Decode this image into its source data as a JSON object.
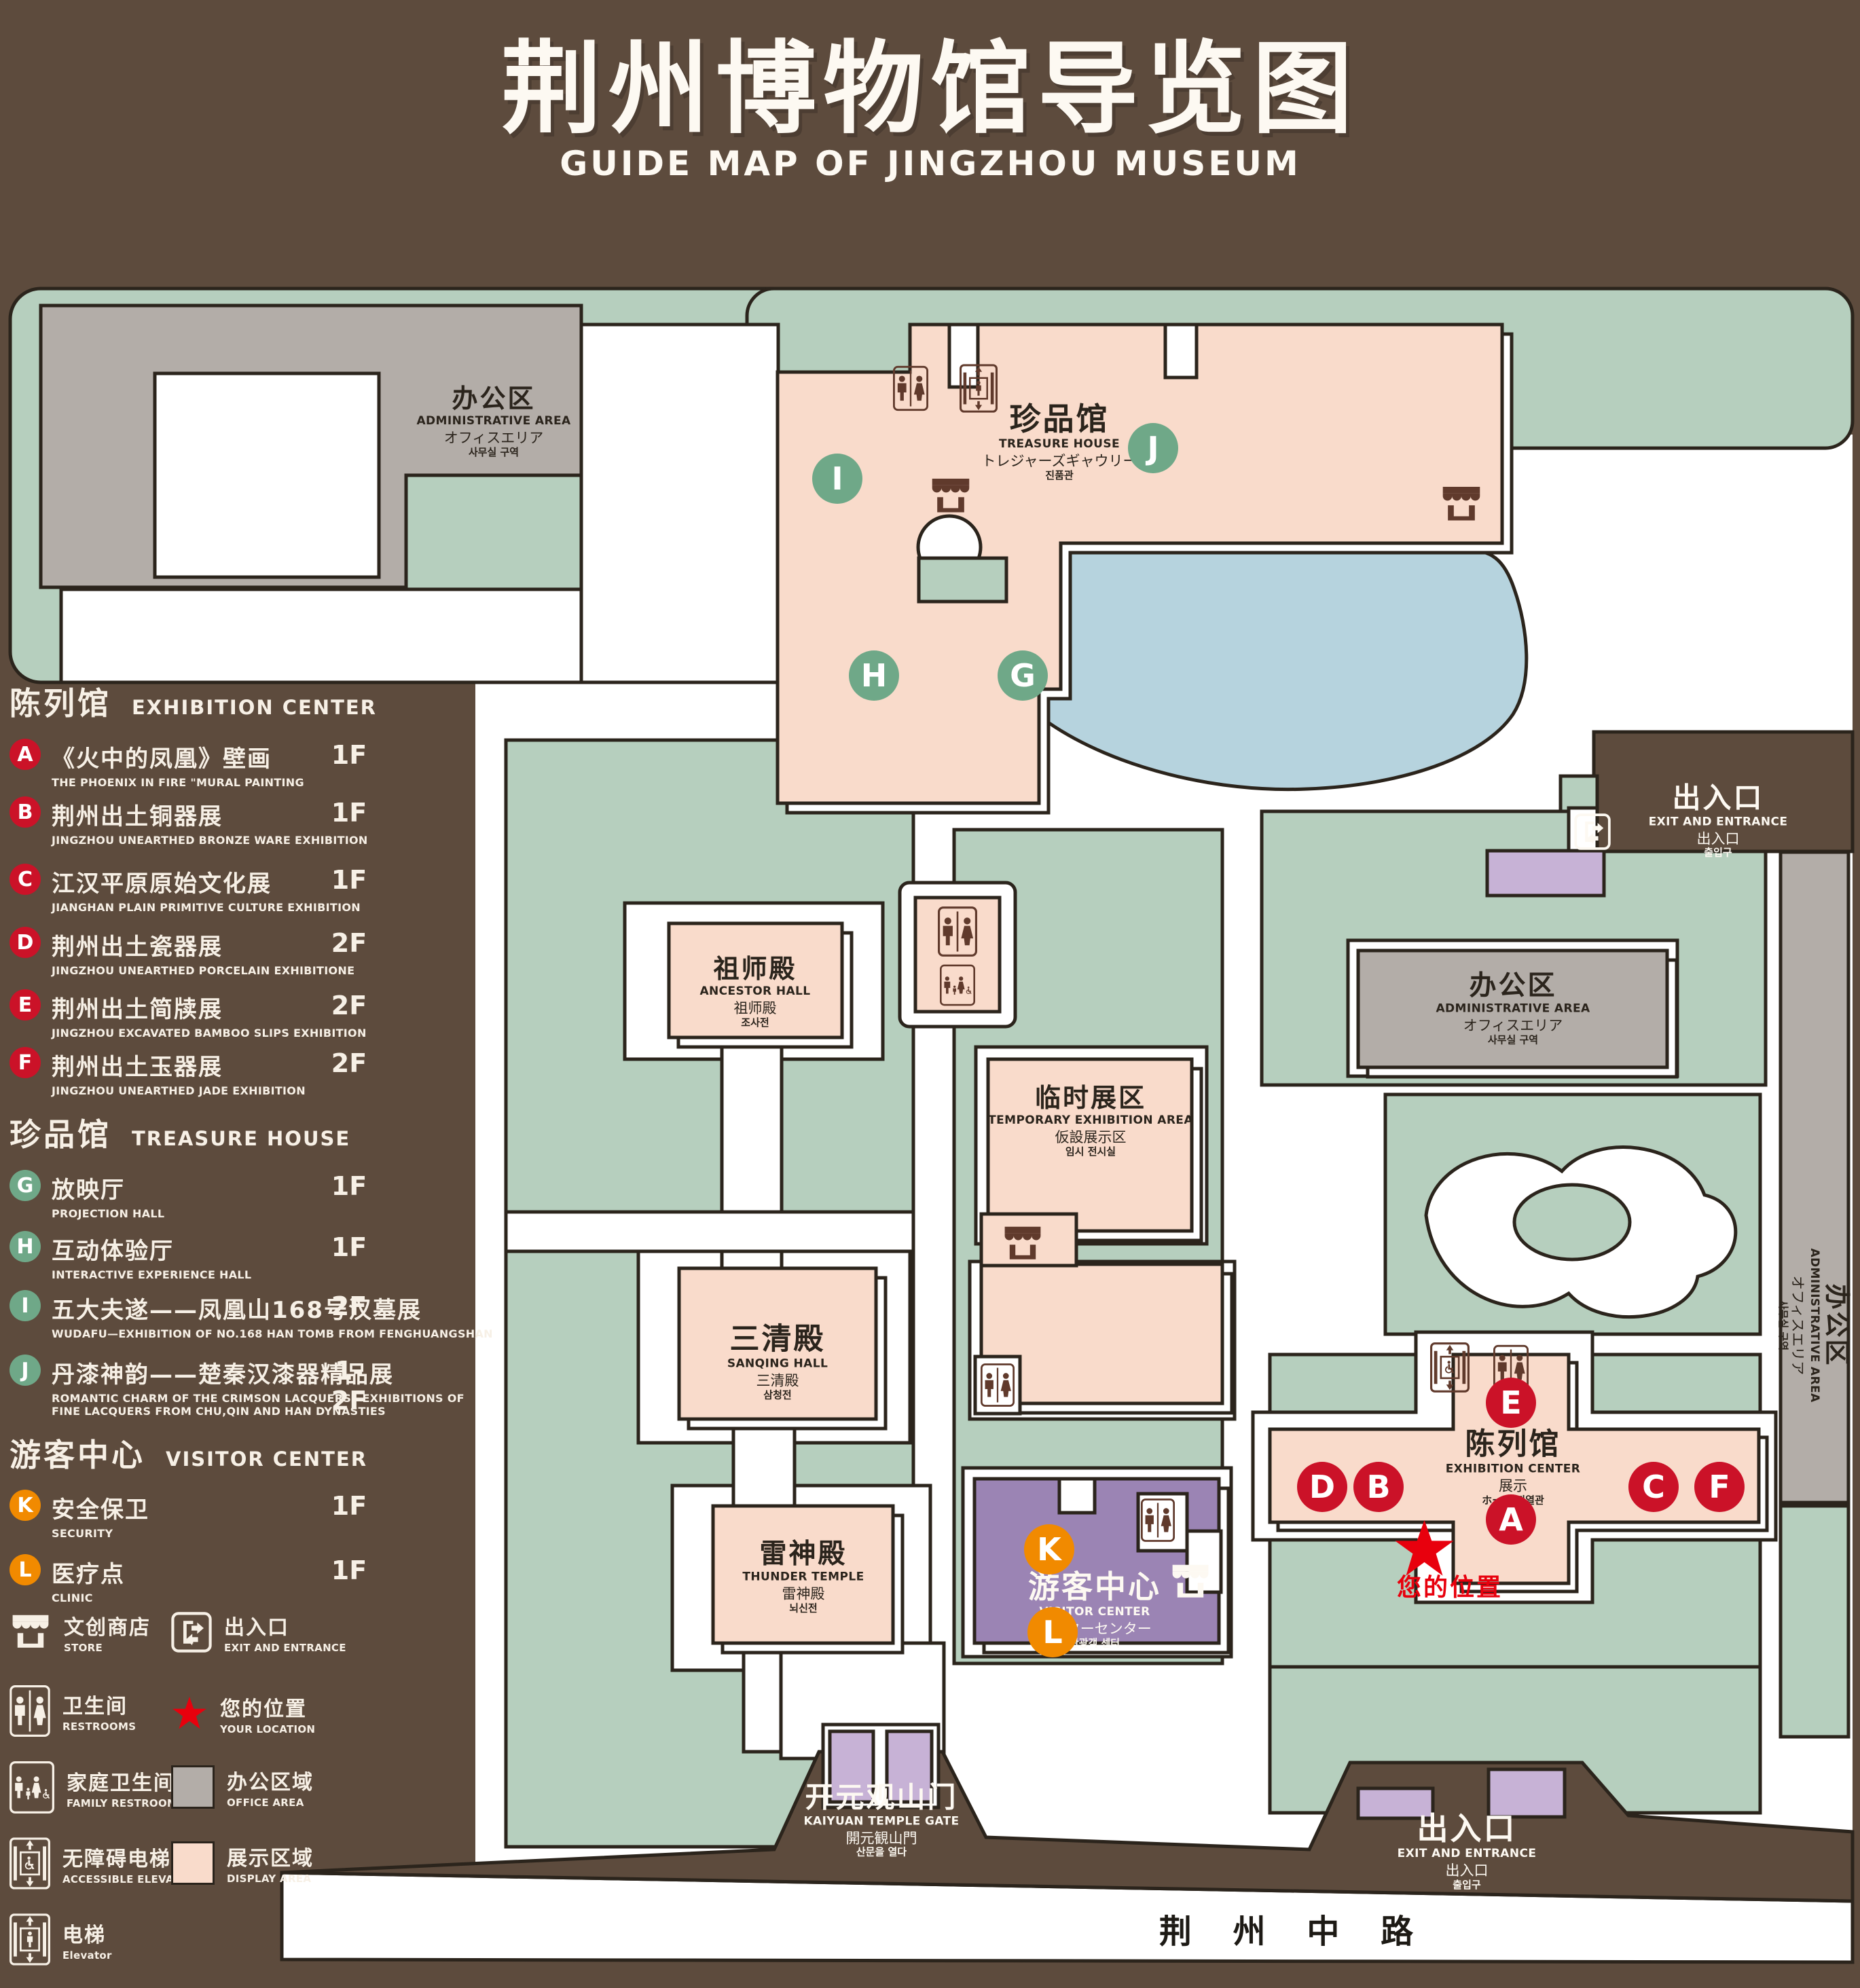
{
  "title": {
    "zh": "荆州博物馆导览图",
    "en": "GUIDE MAP OF JINGZHOU MUSEUM"
  },
  "legend": {
    "sections": [
      {
        "zh": "陈列馆",
        "en": "EXHIBITION CENTER",
        "items": [
          {
            "letter": "A",
            "zh": "《火中的凤凰》壁画",
            "en": "THE PHOENIX IN FIRE \"MURAL PAINTING",
            "floor": "1F"
          },
          {
            "letter": "B",
            "zh": "荆州出土铜器展",
            "en": "JINGZHOU UNEARTHED BRONZE WARE EXHIBITION",
            "floor": "1F"
          },
          {
            "letter": "C",
            "zh": "江汉平原原始文化展",
            "en": "JIANGHAN PLAIN PRIMITIVE CULTURE EXHIBITION",
            "floor": "1F"
          },
          {
            "letter": "D",
            "zh": "荆州出土瓷器展",
            "en": "JINGZHOU UNEARTHED PORCELAIN EXHIBITIONE",
            "floor": "2F"
          },
          {
            "letter": "E",
            "zh": "荆州出土简牍展",
            "en": "JINGZHOU EXCAVATED BAMBOO SLIPS EXHIBITION",
            "floor": "2F"
          },
          {
            "letter": "F",
            "zh": "荆州出土玉器展",
            "en": "JINGZHOU UNEARTHED JADE EXHIBITION",
            "floor": "2F"
          }
        ]
      },
      {
        "zh": "珍品馆",
        "en": "TREASURE HOUSE",
        "items": [
          {
            "letter": "G",
            "zh": "放映厅",
            "en": "PROJECTION HALL",
            "floor": "1F"
          },
          {
            "letter": "H",
            "zh": "互动体验厅",
            "en": "INTERACTIVE EXPERIENCE HALL",
            "floor": "1F"
          },
          {
            "letter": "I",
            "zh": "五大夫遂——凤凰山168号汉墓展",
            "en": "WUDAFU—EXHIBITION OF NO.168 HAN TOMB FROM FENGHUANGSHAN",
            "floor": "2F"
          },
          {
            "letter": "J",
            "zh": "丹漆神韵——楚秦汉漆器精品展",
            "en": "ROMANTIC CHARM OF THE CRIMSON LACQUERS—EXHIBITIONS OF FINE LACQUERS FROM CHU,QIN AND HAN DYNASTIES",
            "floor": "1-2F"
          }
        ]
      },
      {
        "zh": "游客中心",
        "en": "VISITOR CENTER",
        "items": [
          {
            "letter": "K",
            "zh": "安全保卫",
            "en": "SECURITY",
            "floor": "1F"
          },
          {
            "letter": "L",
            "zh": "医疗点",
            "en": "CLINIC",
            "floor": "1F"
          }
        ]
      }
    ],
    "symbols": {
      "store": {
        "zh": "文创商店",
        "en": "STORE"
      },
      "exit": {
        "zh": "出入口",
        "en": "EXIT AND ENTRANCE"
      },
      "restrooms": {
        "zh": "卫生间",
        "en": "RESTROOMS"
      },
      "location": {
        "zh": "您的位置",
        "en": "YOUR LOCATION"
      },
      "family": {
        "zh": "家庭卫生间",
        "en": "FAMILY RESTROOMS"
      },
      "office": {
        "zh": "办公区域",
        "en": "OFFICE AREA"
      },
      "accessible": {
        "zh": "无障碍电梯",
        "en": "ACCESSIBLE ELEVATOR"
      },
      "display": {
        "zh": "展示区域",
        "en": "DISPLAY AREA"
      },
      "elevator": {
        "zh": "电梯",
        "en": "Elevator"
      }
    }
  },
  "map": {
    "marker_letters": [
      "A",
      "B",
      "C",
      "D",
      "E",
      "F",
      "G",
      "H",
      "I",
      "J",
      "K",
      "L"
    ],
    "buildings": {
      "admin": {
        "zh": "办公区",
        "en": "ADMINISTRATIVE AREA",
        "ja": "オフィスエリア",
        "ko": "사무실 구역"
      },
      "treasure": {
        "zh": "珍品馆",
        "en": "TREASURE HOUSE",
        "ja": "トレジャーズギャウリー",
        "ko": "진품관"
      },
      "ancestor": {
        "zh": "祖师殿",
        "en": "ANCESTOR HALL",
        "ja": "祖师殿",
        "ko": "조사전"
      },
      "temporary": {
        "zh": "临时展区",
        "en": "TEMPORARY EXHIBITION AREA",
        "ja": "仮設展示区",
        "ko": "임시 전시실"
      },
      "sanqing": {
        "zh": "三清殿",
        "en": "SANQING HALL",
        "ja": "三清殿",
        "ko": "삼청전"
      },
      "thunder": {
        "zh": "雷神殿",
        "en": "THUNDER TEMPLE",
        "ja": "雷神殿",
        "ko": "뇌신전"
      },
      "visitor": {
        "zh": "游客中心",
        "en": "VISITOR CENTER",
        "ja": "ビジターセンター",
        "ko": "관광객 센터"
      },
      "exhibition": {
        "zh": "陈列馆",
        "en": "EXHIBITION CENTER",
        "ja": "展示",
        "ko": "ホール 진열관"
      },
      "gate": {
        "zh": "开元观山门",
        "en": "KAIYUAN TEMPLE GATE",
        "ja": "開元観山門",
        "ko": "산문을 열다"
      },
      "exit": {
        "zh": "出入口",
        "en": "EXIT AND ENTRANCE",
        "ja": "出入口",
        "ko": "출입구"
      }
    },
    "road": "荆 州 中 路",
    "your_location": "您的位置"
  },
  "colors": {
    "background": "#5d4b3d",
    "lawn": "#b6cfbe",
    "display_area": "#f9dbcb",
    "office_area": "#b3ada8",
    "pond": "#b6d3de",
    "visitor_purple": "#9b84b4",
    "gate_purple": "#c7b2d6",
    "outline": "#2b241c",
    "marker_red": "#cb1228",
    "marker_green": "#6fa888",
    "marker_orange": "#f18a00",
    "star_red": "#e8000d",
    "icon_brown": "#603a2c",
    "text_cream": "#f7f0e6"
  }
}
